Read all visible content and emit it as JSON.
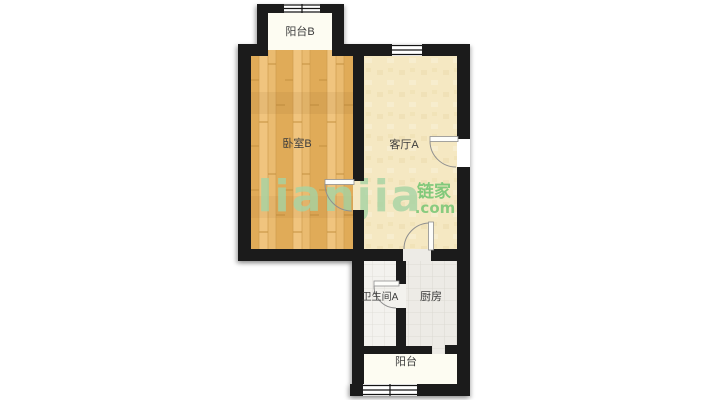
{
  "watermark": {
    "brand": "lianjia",
    "cjk": "链家",
    "tld": ".com"
  },
  "rooms": {
    "balcony_b": "阳台B",
    "bedroom_b": "卧室B",
    "living_a": "客厅A",
    "bathroom_a": "卫生间A",
    "kitchen": "厨房",
    "balcony": "阳台"
  },
  "colors": {
    "wall": "#1b1b1b",
    "bedroom_floor": "#eabb70",
    "bedroom_plank_dark": "#e0ab58",
    "bedroom_plank_light": "#f0c47e",
    "living_floor": "#f5e8c2",
    "bathroom_floor": "#f3f2ee",
    "kitchen_floor": "#edebe6",
    "tile_line": "#dcdad3",
    "balcony_floor": "#fdfcf2",
    "label_text": "#3c3c3c",
    "watermark_brand": "#a6d4a4",
    "watermark_cjk": "#6fc46f",
    "door_line": "#8f8f8f"
  }
}
